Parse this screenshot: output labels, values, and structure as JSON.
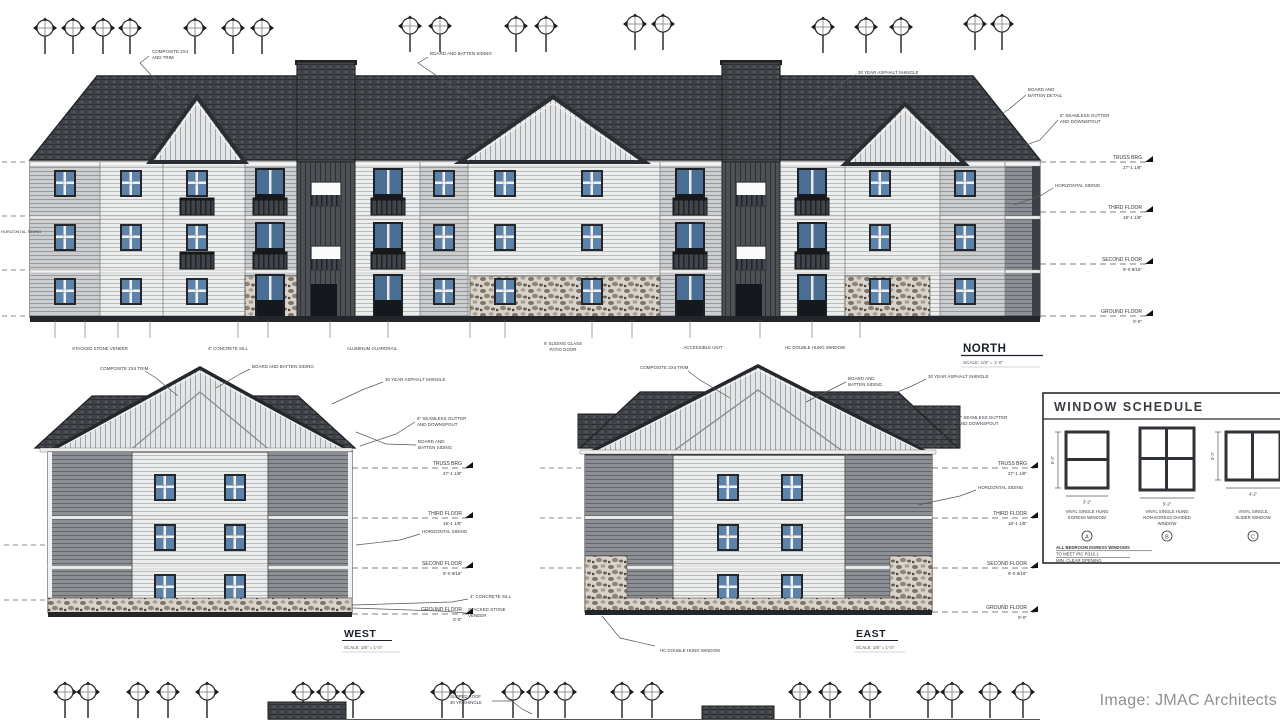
{
  "credit": "Image: JMAC Architects",
  "levels": [
    {
      "label": "TRUSS BRG",
      "elev": "27'-1 1/8\""
    },
    {
      "label": "THIRD FLOOR",
      "elev": "18'-1 1/8\""
    },
    {
      "label": "SECOND FLOOR",
      "elev": "9'-0 9/16\""
    },
    {
      "label": "GROUND FLOOR",
      "elev": "0'-0\""
    }
  ],
  "north": {
    "title": "NORTH",
    "scale": "SCALE: 1/8\" = 1'-0\"",
    "callouts": {
      "trim": [
        "COMPOSITE 2X4",
        "AND TRIM"
      ],
      "board_batten": [
        "BOARD AND BATTEN SIDING"
      ],
      "shingle": [
        "30 YEAR ASPHALT SHINGLE"
      ],
      "batten_detail": [
        "BOARD AND",
        "BATTEN DETAIL"
      ],
      "gutter": [
        "6\" SEAMLESS GUTTER",
        "AND DOWNSPOUT"
      ],
      "horizontal_siding": [
        "HORIZONTAL SIDING"
      ],
      "stone": [
        "STACKED STONE VENEER"
      ],
      "sill": [
        "4\" CONCRETE SILL"
      ],
      "guardrail": [
        "ALUMINUM GUARDRAIL"
      ],
      "patio_door": [
        "6' SLIDING GLASS",
        "PATIO DOOR"
      ],
      "accessible": [
        "ACCESSIBLE UNIT"
      ],
      "window": [
        "HC DOUBLE HUNG WINDOW"
      ]
    }
  },
  "west": {
    "title": "WEST",
    "scale": "SCALE: 1/8\" = 1'-0\"",
    "callouts": {
      "trim": [
        "COMPOSITE 2X4 TRIM"
      ],
      "board_batten_top": [
        "BOARD AND BATTEN SIDING"
      ],
      "shingle": [
        "30 YEAR ASPHALT SHINGLE"
      ],
      "gutter": [
        "6\" SEAMLESS GUTTER",
        "AND DOWNSPOUT"
      ],
      "board_batten": [
        "BOARD AND",
        "BATTEN SIDING"
      ],
      "horizontal_siding": [
        "HORIZONTAL SIDING"
      ],
      "sill": [
        "4\" CONCRETE SILL"
      ],
      "stone": [
        "STACKED STONE",
        "VENEER"
      ]
    }
  },
  "east": {
    "title": "EAST",
    "scale": "SCALE: 1/8\" = 1'-0\"",
    "callouts": {
      "trim": [
        "COMPOSITE 2X4 TRIM"
      ],
      "board_batten": [
        "BOARD AND",
        "BATTEN SIDING"
      ],
      "shingle": [
        "30 YEAR ASPHALT SHINGLE"
      ],
      "gutter": [
        "6\" SEAMLESS GUTTER",
        "AND DOWNSPOUT"
      ],
      "horizontal_siding": [
        "HORIZONTAL SIDING"
      ],
      "window": [
        "HC DOUBLE HUNG WINDOW"
      ]
    }
  },
  "site": {
    "roof_callout": [
      "SLOPED ROOF",
      "30 YR SHINGLE"
    ]
  },
  "window_schedule": {
    "title": "WINDOW SCHEDULE",
    "windows": [
      {
        "caption": [
          "VINYL SINGLE HUNG",
          "EGRESS WINDOW"
        ],
        "tag": "A",
        "w": "3'-2\"",
        "h": "5'-2\""
      },
      {
        "caption": [
          "VINYL SINGLE HUNG",
          "NON-EGRESS DIVIDED",
          "WINDOW"
        ],
        "tag": "B",
        "w": "5'-2\"",
        "h": ""
      },
      {
        "caption": [
          "VINYL SINGLE",
          "SLIDER WINDOW"
        ],
        "tag": "C",
        "w": "4'-2\"",
        "h": "3'-2\""
      }
    ],
    "note": [
      "ALL BEDROOM EGRESS WINDOWS",
      "TO MEET IRC R310.1",
      "MIN. CLEAR OPENING"
    ]
  }
}
